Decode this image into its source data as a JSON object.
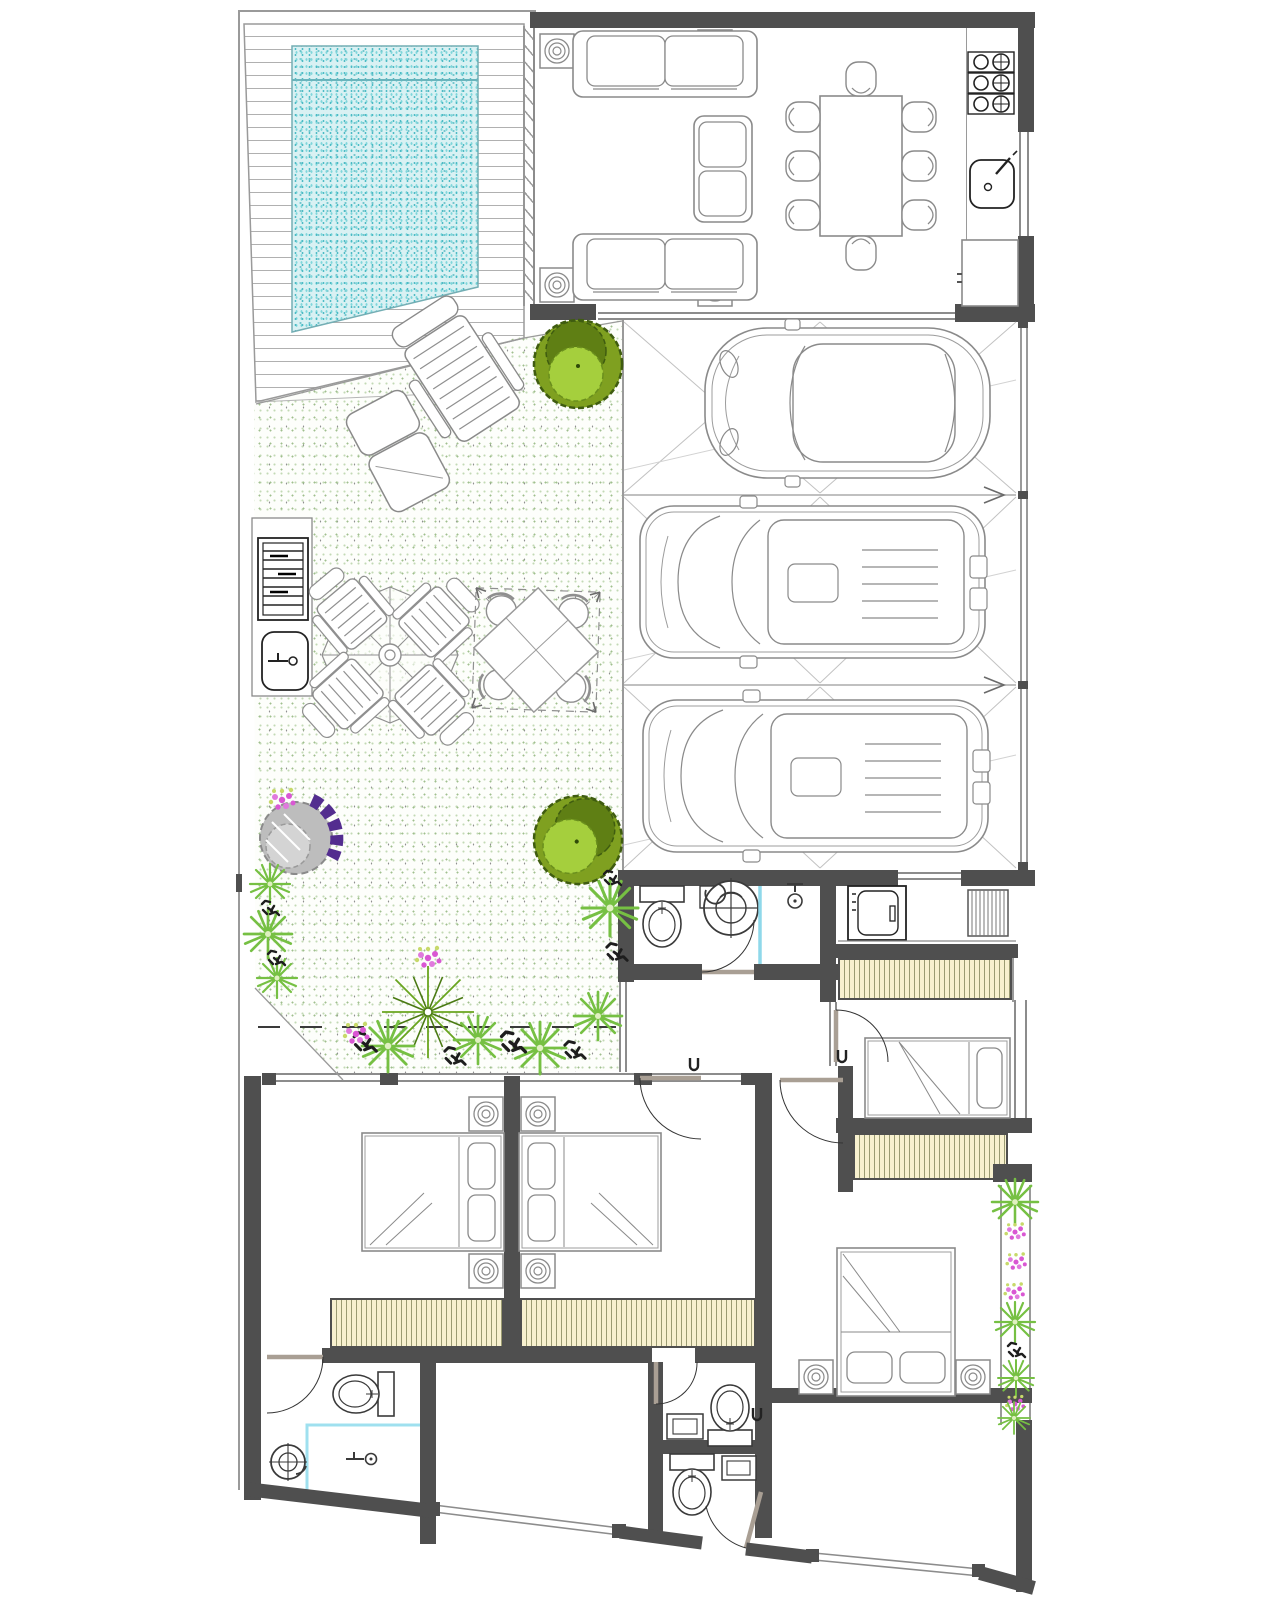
{
  "document": {
    "type": "architectural-floor-plan",
    "title": "Single-storey residential floor plan, top view, with pool, patio, three-car driveway, bedrooms and bathrooms",
    "visible_text": []
  },
  "palette": {
    "wall": "#4f4f4f",
    "thin_line": "#9a9a9a",
    "furniture_line": "#8a8a8a",
    "pool_base": "#d9f1f3",
    "pool_water_dots": "#45b8c2",
    "deck_plank_line": "#b0b0b0",
    "garden_dot_green": "#9fbf8d",
    "closet_fill": "#f8f1cf",
    "closet_stripe": "#9b9b72",
    "glass_partition_cyan": "#8fd8ea",
    "tree_outline": "#3f5c10",
    "tree_mid": "#7fa020",
    "tree_light": "#a5cf3d",
    "palm_green": "#69a51f",
    "fern_green": "#76c043",
    "flower_magenta": "#d957d3",
    "bush_purple": "#532d8f",
    "bush_gray": "#bdbdbd"
  },
  "areas": [
    {
      "name": "pool-deck",
      "features": [
        "wood-plank hatch",
        "diagonal ticks"
      ]
    },
    {
      "name": "swimming-pool",
      "features": [
        "cyan stipple water",
        "lane line"
      ]
    },
    {
      "name": "living-dining-room",
      "features": [
        "2 sofas",
        "loveseat",
        "4 lamp side tables",
        "dining table with 8 chairs"
      ]
    },
    {
      "name": "kitchen-strip",
      "features": [
        "stove with 3 burner modules",
        "sink",
        "counter appliance",
        "window"
      ]
    },
    {
      "name": "garden-patio",
      "features": [
        "green stipple ground",
        "2 lounge chairs",
        "umbrella table with 4 striped chairs",
        "canopy table with 4 chairs",
        "bbq grill",
        "outdoor sink",
        "2 round trees",
        "purple shrub",
        "palm",
        "flower beds",
        "dashed boundary line"
      ]
    },
    {
      "name": "garage-driveway",
      "features": [
        "3 parking bays with X tile pattern",
        "3 cars",
        "bay separator arrows",
        "side gate line"
      ]
    },
    {
      "name": "garage-bathroom",
      "features": [
        "toilet",
        "shower drain fan",
        "shower head",
        "cyan glass partition",
        "door"
      ]
    },
    {
      "name": "laundry-room",
      "features": [
        "washing machine",
        "drying rack",
        "window"
      ]
    },
    {
      "name": "wardrobe-strip-1",
      "features": [
        "striped closet"
      ]
    },
    {
      "name": "small-bedroom",
      "features": [
        "single bed",
        "window",
        "door"
      ]
    },
    {
      "name": "wardrobe-strip-2",
      "features": [
        "striped closet"
      ]
    },
    {
      "name": "hallway",
      "features": [
        "doors to bedrooms and bathroom"
      ]
    },
    {
      "name": "bedroom-left",
      "features": [
        "double bed",
        "2 lamp tables",
        "wardrobe",
        "door"
      ]
    },
    {
      "name": "bedroom-middle",
      "features": [
        "double bed",
        "2 lamp tables",
        "wardrobe",
        "door"
      ]
    },
    {
      "name": "bedroom-right-bottom",
      "features": [
        "double bed",
        "2 lamp tables",
        "wardrobe",
        "door"
      ]
    },
    {
      "name": "bathroom-bottom-left",
      "features": [
        "toilet",
        "shower corner with drain",
        "faucet",
        "door"
      ]
    },
    {
      "name": "wc-1",
      "features": [
        "toilet",
        "sink",
        "door"
      ]
    },
    {
      "name": "wc-2",
      "features": [
        "toilet",
        "sink",
        "slanted entrance door"
      ]
    },
    {
      "name": "bottom-right-room",
      "features": [
        "empty room",
        "slanted window wall"
      ]
    },
    {
      "name": "planter-strip",
      "features": [
        "vertical bed of ferns and flowers"
      ]
    }
  ],
  "inventory": {
    "sofas": 2,
    "loveseat": 1,
    "living_lamp_side_tables": 4,
    "dining_chairs": 8,
    "stove_burner_modules": 3,
    "kitchen_sink": 1,
    "kitchen_counter_appliance": 1,
    "cars": 3,
    "parking_bays": 3,
    "lounge_chairs": 2,
    "striped_patio_chairs": 4,
    "round_patio_chairs": 4,
    "umbrella_table": 1,
    "canopy_table": 1,
    "bbq_grill": 1,
    "outdoor_sink": 1,
    "round_trees": 2,
    "purple_shrub": 1,
    "palms": 2,
    "toilets": 4,
    "showers": 2,
    "washing_machine": 1,
    "drying_rack": 1,
    "double_beds": 3,
    "single_beds": 1,
    "bedside_lamp_tables": 6,
    "wardrobe_strips": 4,
    "interior_doors": 8
  }
}
